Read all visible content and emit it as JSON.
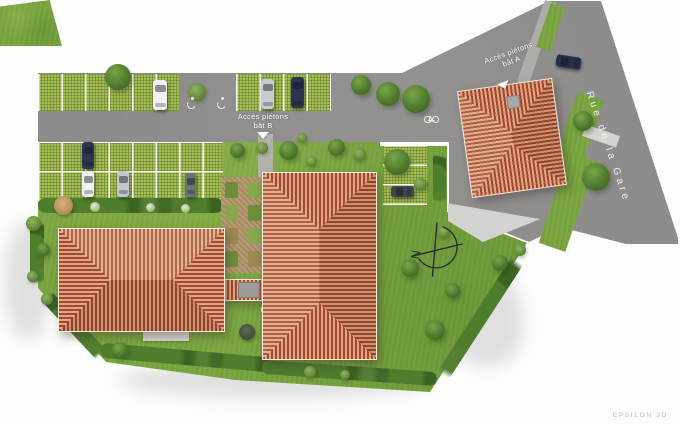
{
  "site_plan": {
    "annotations": {
      "access_b": {
        "line1": "Accès piétons",
        "line2": "bât B"
      },
      "access_a": {
        "line1": "Accès piétons",
        "line2": "bât A"
      },
      "street_name": "Rue de la Gare",
      "credit": "EPSILON 3D",
      "compass_north": "N"
    },
    "icons": {
      "north_arrow": "compass-north-icon",
      "pedestrian_arrow": "arrow-down-icon",
      "accessible_parking": "wheelchair-icon",
      "bicycle_parking": "bicycle-icon"
    },
    "colors": {
      "background": "#fdfdfd",
      "asphalt": "#8d8c8b",
      "lawn": "#76a23c",
      "grass_pavers": "#a6bf54",
      "roof_dark": "#a04a32",
      "roof_light": "#e3a57f",
      "hedge": "#44702a",
      "label_text": "#ffffff",
      "credit_text": "#b3b6ba"
    }
  }
}
